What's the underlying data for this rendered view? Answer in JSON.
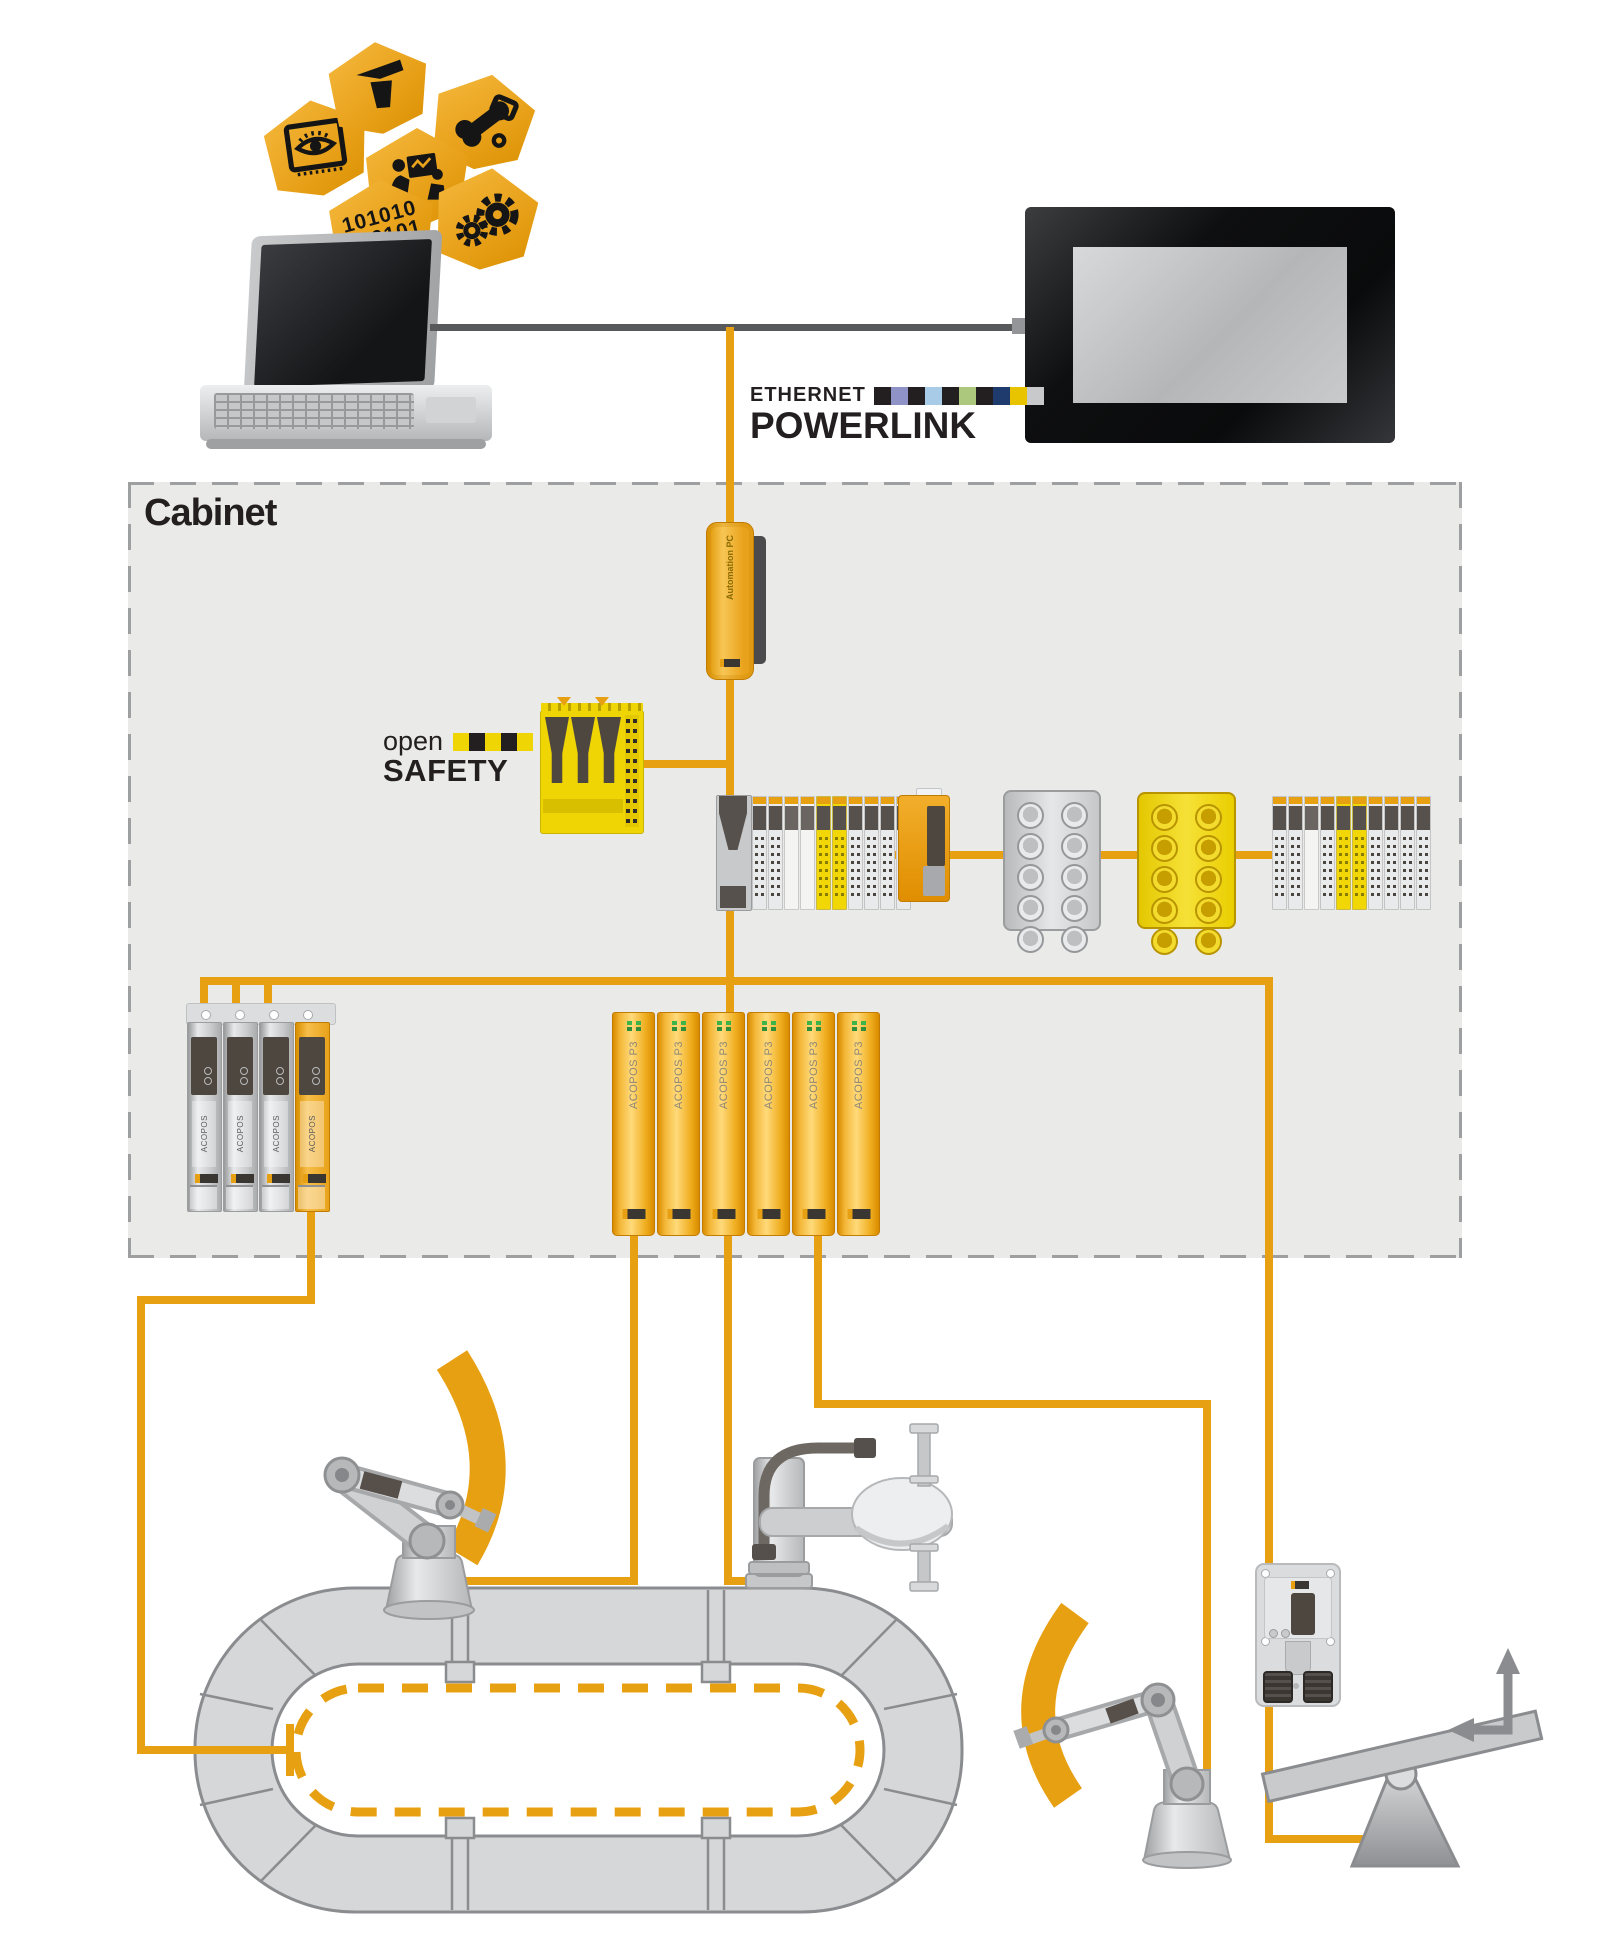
{
  "colors": {
    "accent_orange": "#E8A013",
    "safety_yellow": "#EFD504",
    "line_gray": "#58595B",
    "cabinet_bg": "#EAEAE8",
    "dark_panel": "#4E4740",
    "device_gray": "#D2D3D5"
  },
  "top": {
    "hexagons": [
      {
        "icon": "press-icon"
      },
      {
        "icon": "diagnostics-icon"
      },
      {
        "icon": "vision-icon"
      },
      {
        "icon": "collaboration-icon"
      },
      {
        "icon": "binary-icon"
      },
      {
        "icon": "gears-icon"
      }
    ],
    "binary_line1": "101010",
    "binary_line2": "010101"
  },
  "powerlink": {
    "line1": "ETHERNET",
    "line2": "POWERLINK",
    "strip": [
      "#231F20",
      "#8E92C6",
      "#231F20",
      "#A8CBE8",
      "#231F20",
      "#ABC87D",
      "#231F20",
      "#1F3B6D",
      "#E8C400",
      "#C8C9CB"
    ]
  },
  "opensafety": {
    "line1": "open",
    "line2": "SAFETY",
    "strip": [
      "#EFD504",
      "#231F20",
      "#EFD504",
      "#231F20",
      "#EFD504"
    ]
  },
  "cabinet": {
    "label": "Cabinet",
    "automation_pc": {
      "label": "Automation PC"
    },
    "x20_station_1": {
      "modules": [
        "gray",
        "gray",
        "white",
        "white",
        "yellow",
        "yellow",
        "gray",
        "gray",
        "gray",
        "gray"
      ]
    },
    "x20_station_2": {
      "modules": [
        "gray",
        "gray",
        "white",
        "gray",
        "yellow",
        "yellow",
        "gray",
        "gray",
        "gray",
        "gray"
      ]
    },
    "x67_gray": {
      "connector_count": 10
    },
    "x67_yellow": {
      "connector_count": 10
    },
    "acopos_multi": {
      "drives": [
        "ACOPOS",
        "ACOPOS",
        "ACOPOS",
        "ACOPOS"
      ]
    },
    "acopos_p3": {
      "drives": [
        "ACOPOS P3",
        "ACOPOS P3",
        "ACOPOS P3",
        "ACOPOS P3",
        "ACOPOS P3",
        "ACOPOS P3"
      ]
    }
  }
}
